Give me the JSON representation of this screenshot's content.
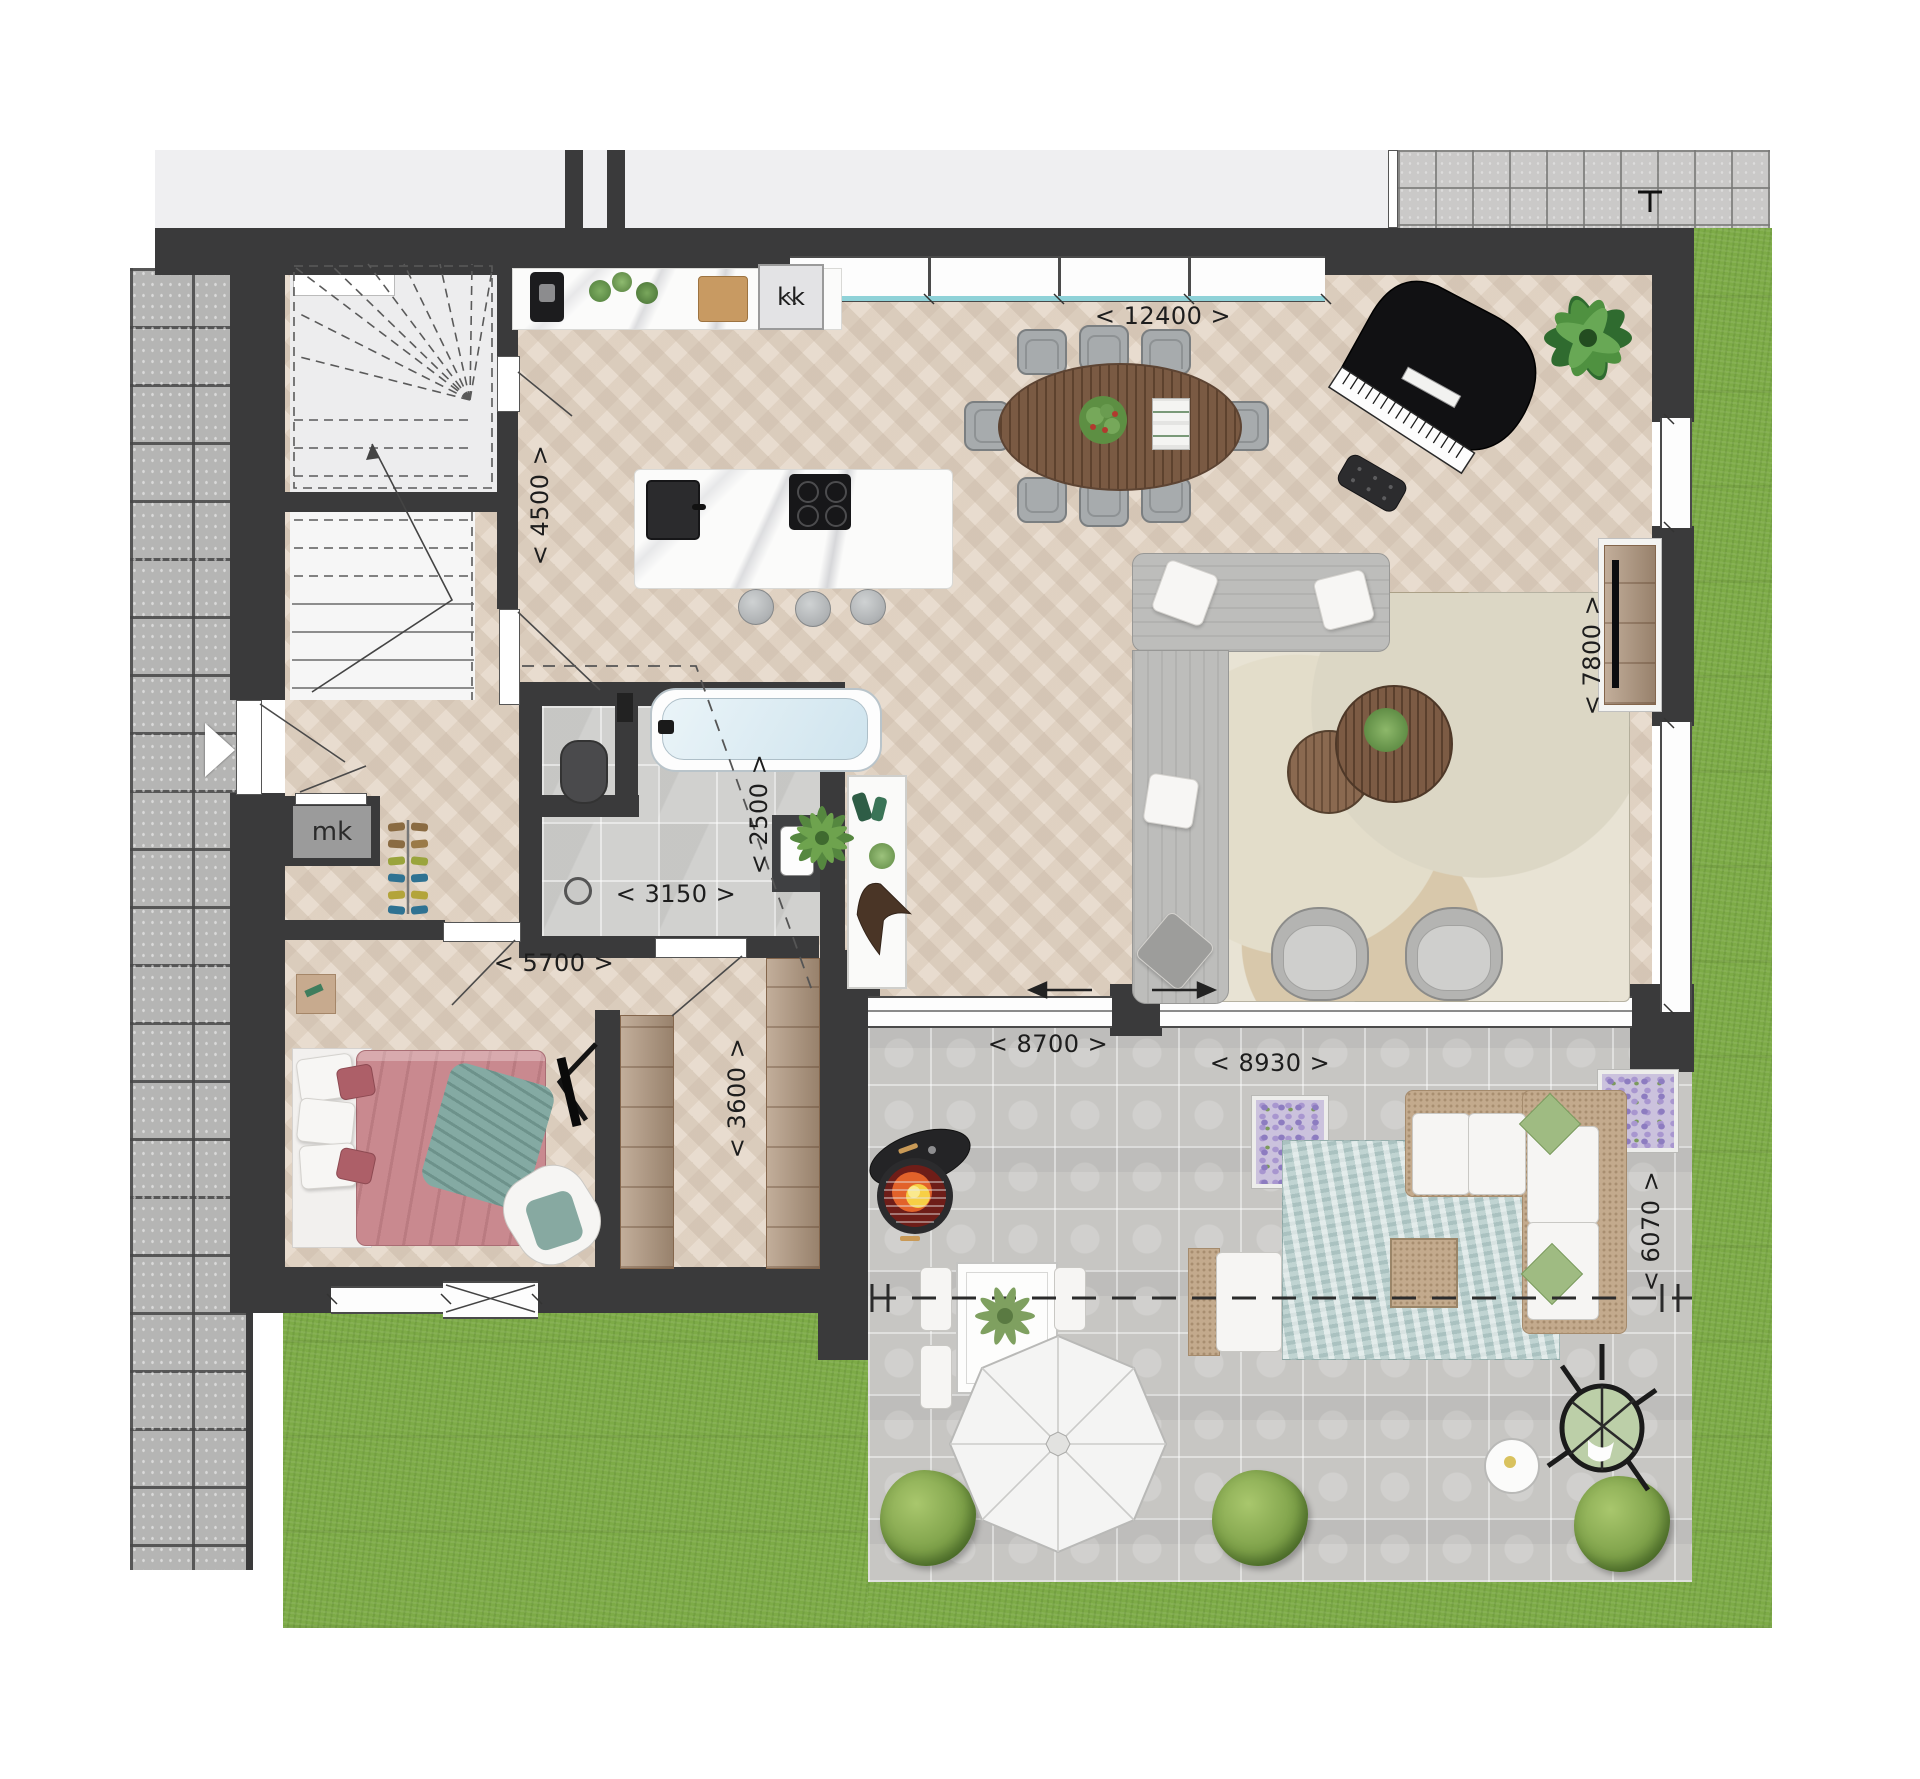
{
  "plan_type": "residential-floor-plan",
  "rooms": {
    "meter_closet": "mk",
    "kitchen_unit": "kk"
  },
  "dimensions": {
    "d12400": "< 12400 >",
    "d4500": "< 4500 >",
    "d7800": "< 7800 >",
    "d2500": "< 2500 >",
    "d3150": "< 3150 >",
    "d5700": "< 5700 >",
    "d3600": "< 3600 >",
    "d8700": "< 8700 >",
    "d8930": "< 8930 >",
    "d6070": "< 6070 >"
  },
  "colors": {
    "wall": "#3a3a3b",
    "wood_floor": "#e8dccf",
    "bath_tile": "#d1d1cf",
    "terrace_tile": "#c7c6c3",
    "grass": "#7dab47",
    "paving": "#b5b5b4",
    "window_glass": "#8fd2d8",
    "duvet_pink": "#c9898f",
    "throw_teal": "#84aaa3",
    "lavender": "#a896cf"
  }
}
